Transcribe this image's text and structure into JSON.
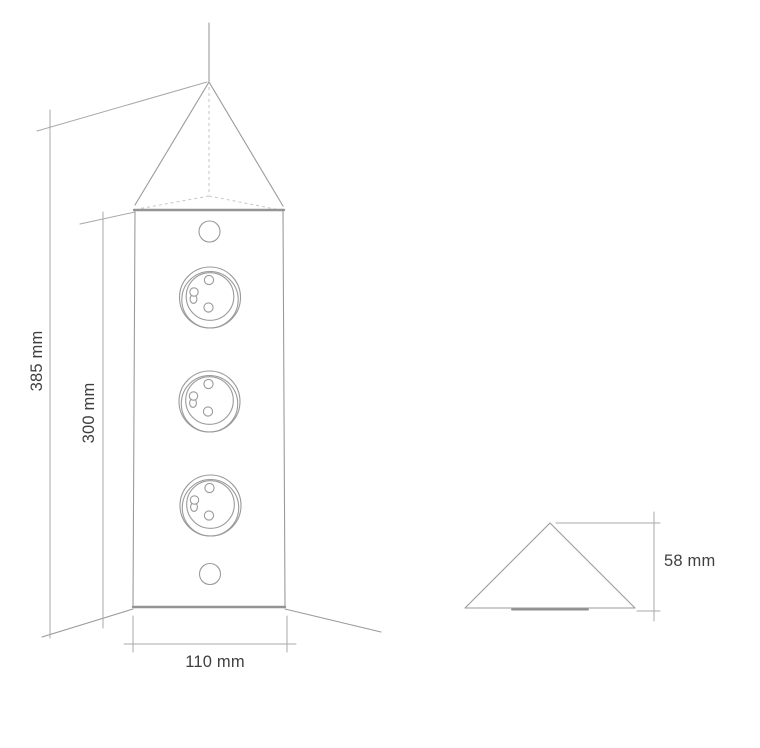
{
  "drawing_type": "technical-dimension-drawing",
  "subject": "corner-mounted triangular power tower with three sockets, front and side profile views",
  "colors": {
    "line": "#9a9a9a",
    "line_thick": "#949494",
    "line_dashed": "#c6c6c6",
    "dimension": "#a8a8a8",
    "text": "#3f3f3f",
    "background": "#ffffff"
  },
  "front_view": {
    "socket_count": 3,
    "dimensions": {
      "overall_height": "385 mm",
      "body_height": "300 mm",
      "body_width": "110 mm"
    }
  },
  "side_view": {
    "dimensions": {
      "cap_height": "58 mm"
    }
  }
}
